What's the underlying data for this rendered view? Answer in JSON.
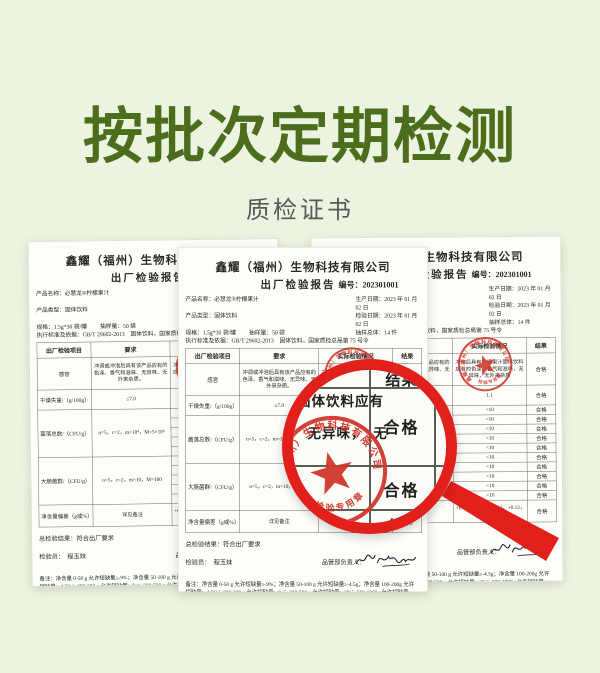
{
  "banner": {
    "title": "按批次定期检测",
    "subtitle": "质检证书"
  },
  "colors": {
    "title_green": "#4b6d1c",
    "background": "#ecf4e1",
    "magnifier_red": "#e2201b",
    "stamp_red": "#cf372c",
    "paper": "#fdfdfa"
  },
  "report": {
    "company": "鑫耀（福州）生物科技有限公司",
    "doc_title": "出厂检验报告",
    "no_label": "编号：202301001",
    "meta": {
      "product_name": "产品名称：必慧龙®柠檬果汁",
      "product_type": "产品类型：固体饮料",
      "spec": "规格：1.5g*30 袋/罐",
      "sample_qty": "抽样量：50 袋",
      "prod_date": "生产日期：2023 年 01 月 02 日",
      "insp_date": "检验日期：2023 年 01 月 02 日",
      "sample_total": "抽样总体：14 件",
      "standard": "执行标准及依据：GB/T 29602-2013　固体饮料，国家质检总局第 75 号令"
    },
    "table": {
      "headers": [
        "出厂检验项目",
        "要求",
        "实际检验情况",
        "结果"
      ],
      "rows": [
        {
          "item": "感官",
          "req": "冲调或冲泡后具有该产品应有的色泽、香气和滋味、无异味、无外来杂质。",
          "actual": "冲泡后具有柠檬果汁固体饮料应有的色泽、香气和滋味，无异味，无外来杂质",
          "result": "合格",
          "h": 64
        },
        {
          "item": "干燥失重/（g/100g）",
          "req": "≤7.0",
          "actual": "1.1",
          "result": "合格",
          "h": 40
        },
        {
          "item": "菌落总数/（CFU/g）",
          "req": "n=5，c=2，m=10⁴，M=5×10⁵",
          "actuals": [
            "<10",
            "<10",
            "<10",
            "<10",
            "<10"
          ],
          "results": [
            "合格",
            "合格",
            "合格",
            "合格",
            "合格"
          ],
          "subh": 19
        },
        {
          "item": "大肠菌群/（CFU/g）",
          "req": "n=5，c=2，m=10，M=100",
          "actuals": [
            "<10",
            "<10",
            "<10",
            "<10",
            "<10"
          ],
          "results": [
            "合格",
            "合格",
            "合格",
            "合格",
            "合格"
          ],
          "subh": 19
        },
        {
          "item": "净含量偏差（g或%）",
          "req": "详见备注",
          "actual": "+0.14，+0.11，+0.13，+0.12，+0.12，+0.14",
          "result": "合格",
          "h": 44
        }
      ]
    },
    "footer": {
      "overall": "总检验结果：符合出厂要求",
      "inspector": "检验员：　程玉妹",
      "manager": "品管部负责人：",
      "note": "备注：净含量 0-50 g 允许短缺量≥-9%；净含量 50-100 g 允许短缺量≥-4.5g；净含量 100-200g 允许短缺量≥-4.5%；200-300 g 允许短缺量≥-9g；300-500 g 允许短缺量≥-3%；500-1000g 允许短缺量≥-15g。"
    },
    "stamp": {
      "org": "鑫耀（福州）生物科技有限公司",
      "label": "检验专用章"
    }
  },
  "magnifier": {
    "header": "结果",
    "results": [
      "合格",
      "合格",
      "合格"
    ],
    "fragment_line1": "固体饮料应有",
    "fragment_line2": "　无异味，　无"
  }
}
